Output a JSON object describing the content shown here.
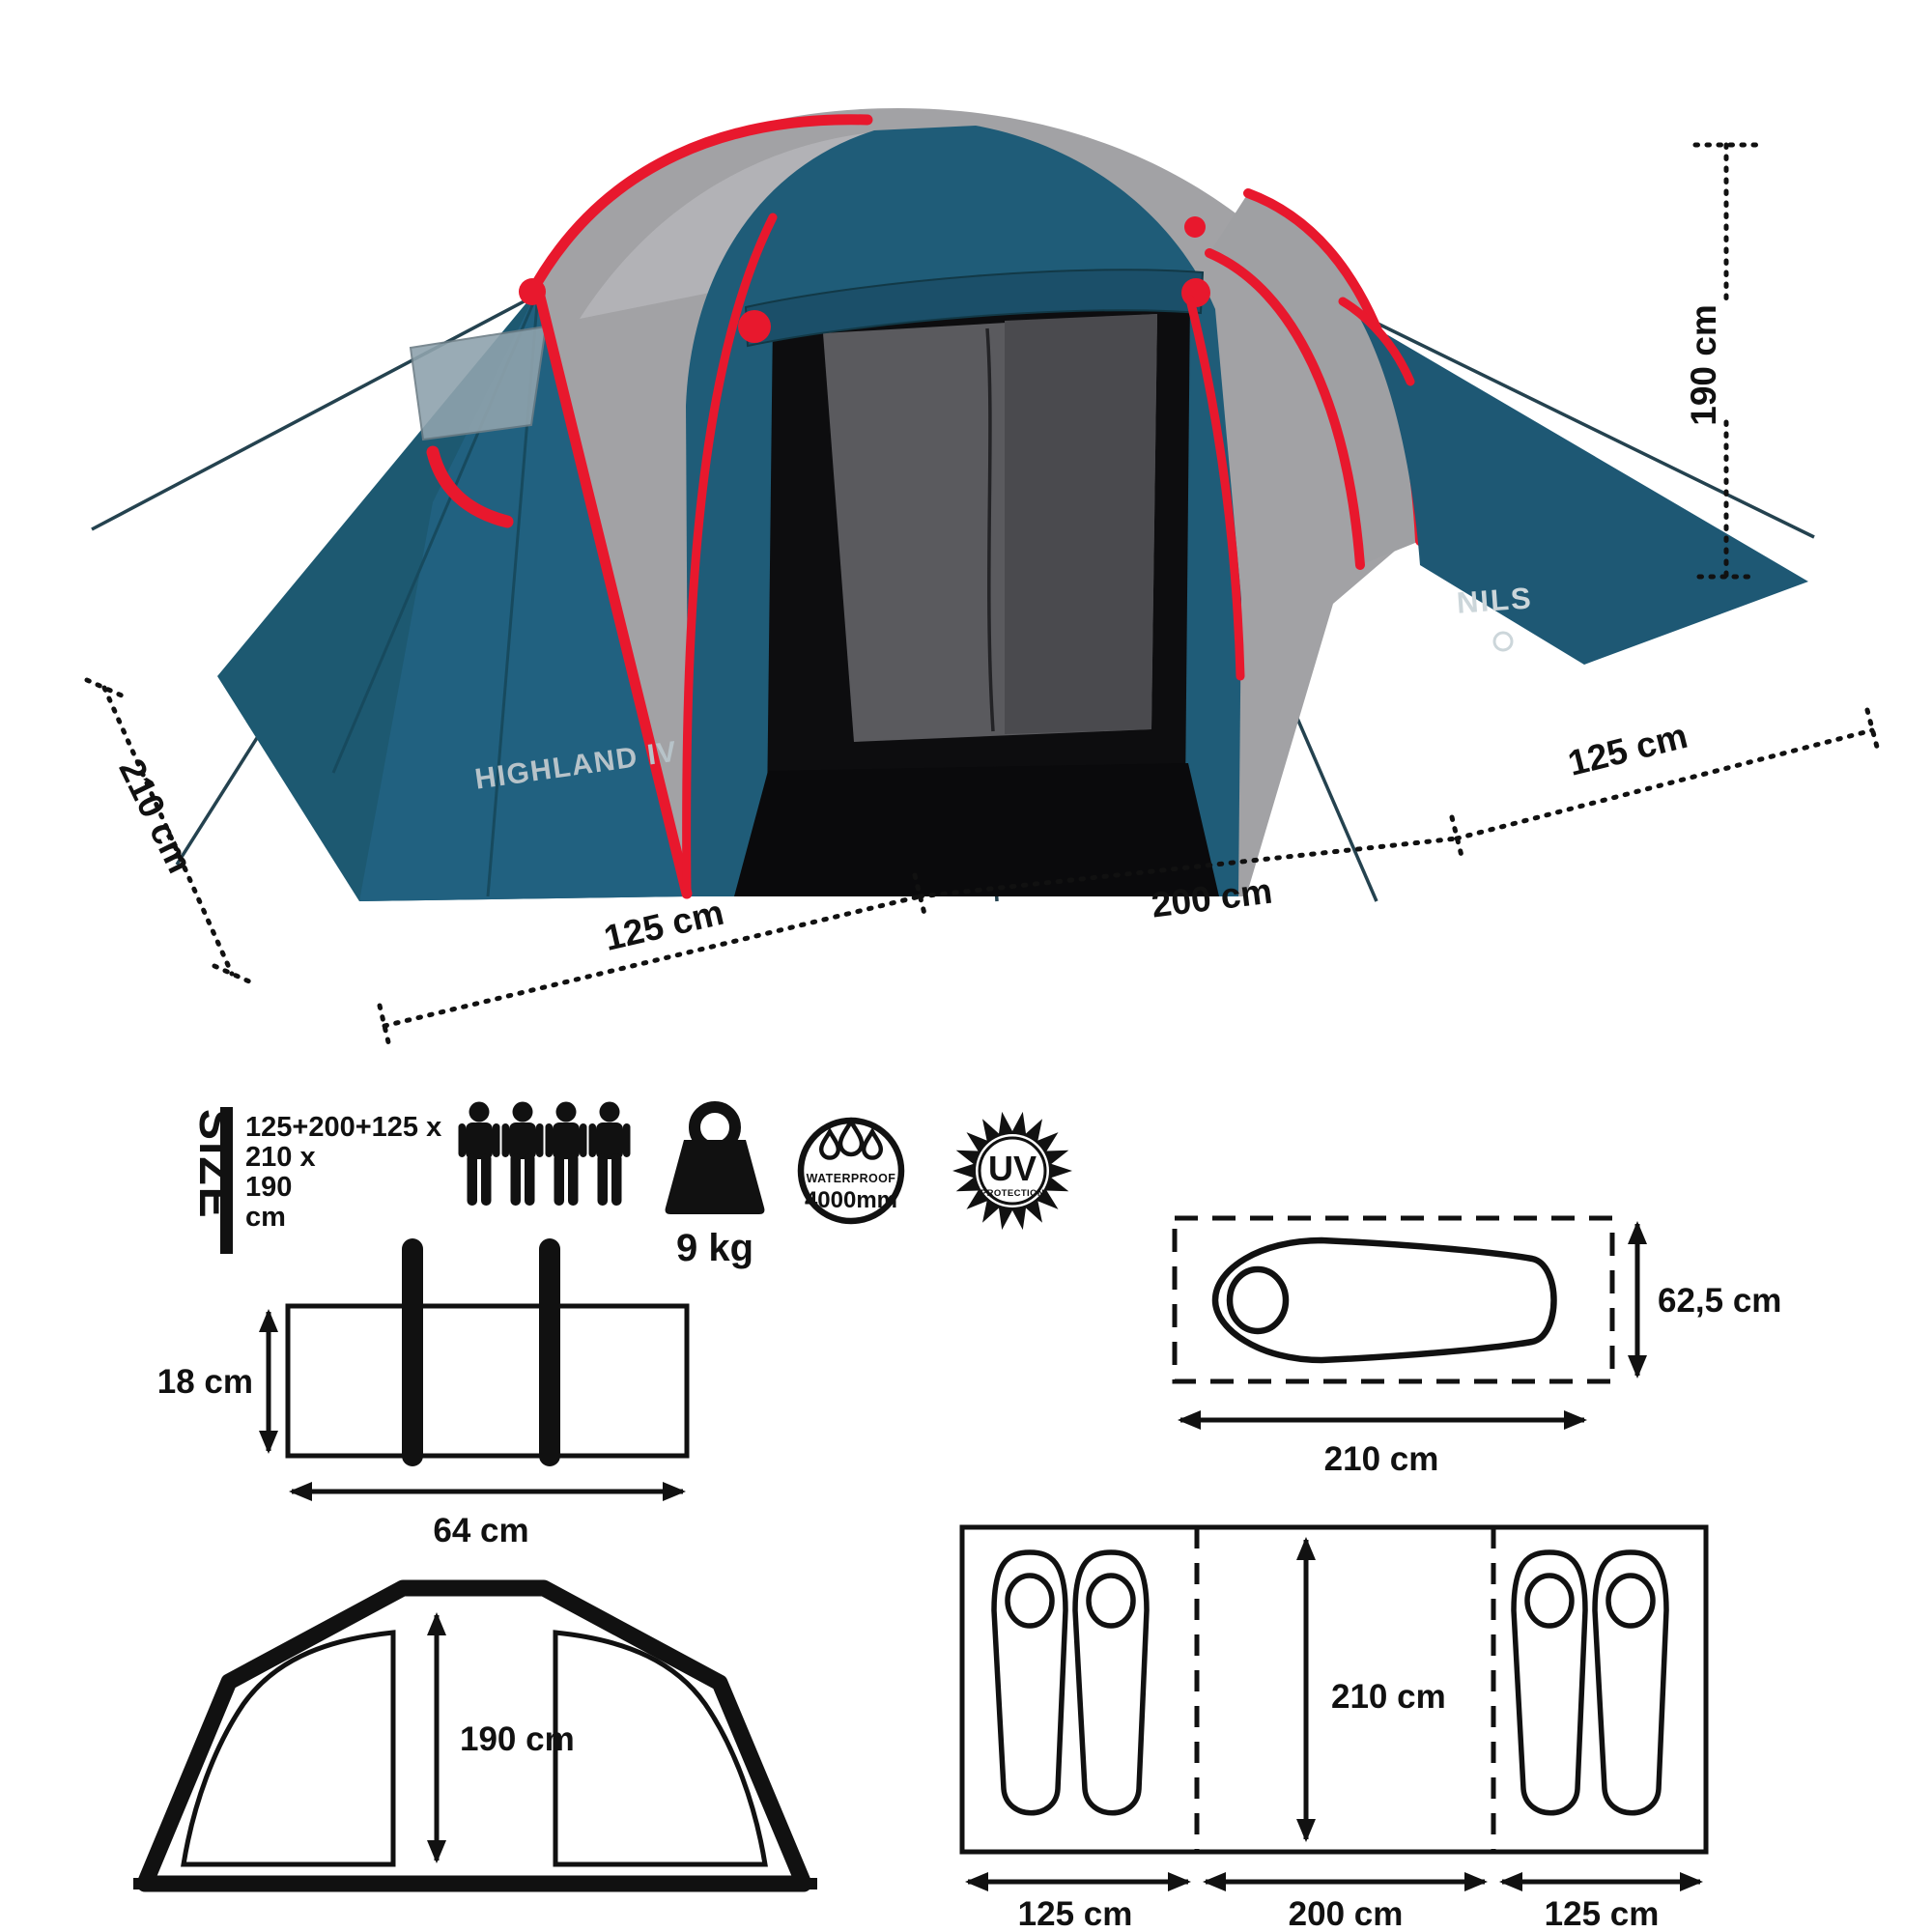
{
  "hero": {
    "brand": "NILS",
    "model": "HIGHLAND IV",
    "dims": {
      "height": "190 cm",
      "right_width": "125 cm",
      "center_width": "200 cm",
      "left_width": "125 cm",
      "depth": "210 cm"
    }
  },
  "specs": {
    "size_heading": "SIZE",
    "size_lines": [
      "125+200+125 x",
      "210 x",
      "190",
      "cm"
    ],
    "persons": 4,
    "weight": "9 kg",
    "waterproof_title": "WATERPROOF",
    "waterproof_value": "4000mm",
    "uv_title": "UV",
    "uv_subtitle": "PROTECTION"
  },
  "pack": {
    "height": "18 cm",
    "width": "64 cm"
  },
  "mat": {
    "height": "62,5 cm",
    "length": "210 cm"
  },
  "front_view": {
    "height": "190 cm"
  },
  "floor_plan": {
    "inner_length": "210 cm",
    "left_room": "125 cm",
    "center_room": "200 cm",
    "right_room": "125 cm"
  },
  "colors": {
    "tent_blue": "#1F5C78",
    "tent_blue_dark": "#1D5971",
    "fly_gray": "#A2A2A5",
    "trim_red": "#E8182D",
    "line_black": "#111111",
    "logo_gray": "#B7C3C9"
  }
}
